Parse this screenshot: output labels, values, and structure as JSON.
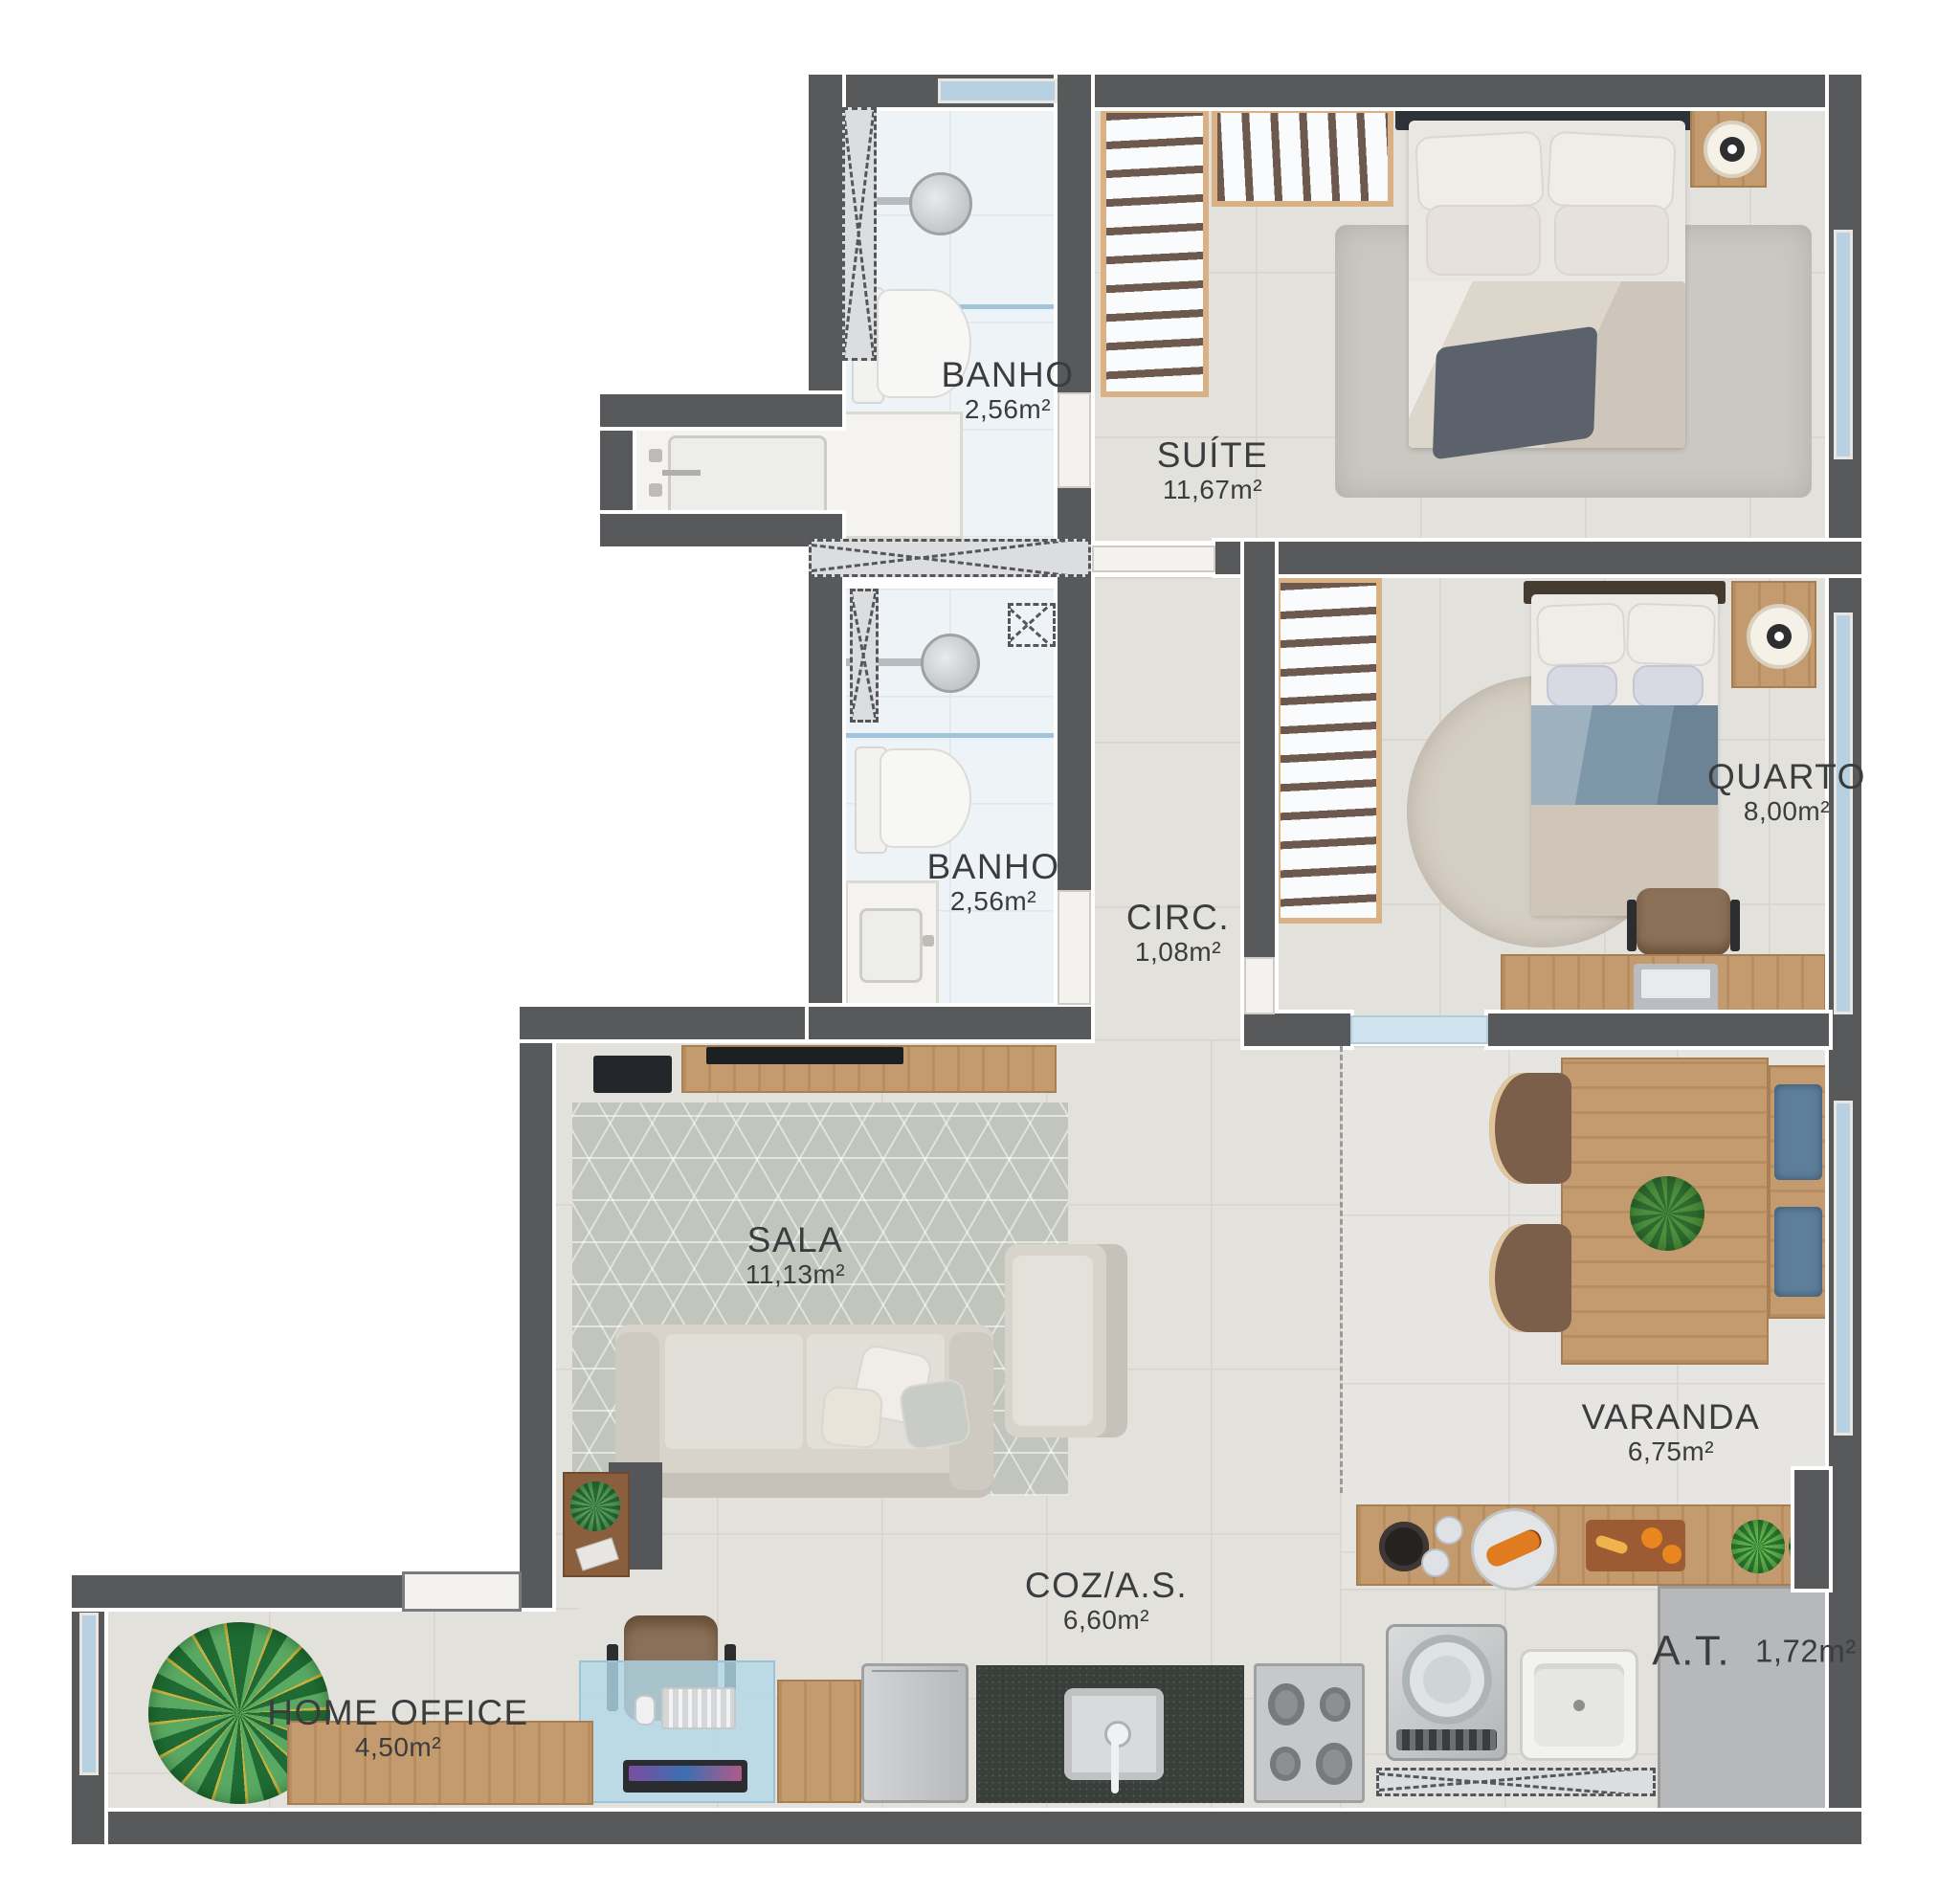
{
  "plan": {
    "type": "apartment-floor-plan",
    "language": "pt-BR",
    "rooms": {
      "banho_suite": {
        "name": "BANHO",
        "area": "2,56m²"
      },
      "suite": {
        "name": "SUÍTE",
        "area": "11,67m²"
      },
      "banho_social": {
        "name": "BANHO",
        "area": "2,56m²"
      },
      "circ": {
        "name": "CIRC.",
        "area": "1,08m²"
      },
      "quarto": {
        "name": "QUARTO",
        "area": "8,00m²"
      },
      "sala": {
        "name": "SALA",
        "area": "11,13m²"
      },
      "varanda": {
        "name": "VARANDA",
        "area": "6,75m²"
      },
      "coz_as": {
        "name": "COZ/A.S.",
        "area": "6,60m²"
      },
      "home_office": {
        "name": "HOME OFFICE",
        "area": "4,50m²"
      },
      "at": {
        "name": "A.T.",
        "area": "1,72m²"
      }
    },
    "colors": {
      "wall": "#58595b",
      "floor": "#e3e1dc",
      "bath_floor": "#eef3f7",
      "window_glass": "#b7d0e2",
      "wood": "#c49b6e",
      "at_gray": "#b6b8ba",
      "blanket_blue": "#7e97a9",
      "cushion_blue": "#5e7f9b",
      "label_text": "#3b3c3e"
    }
  }
}
